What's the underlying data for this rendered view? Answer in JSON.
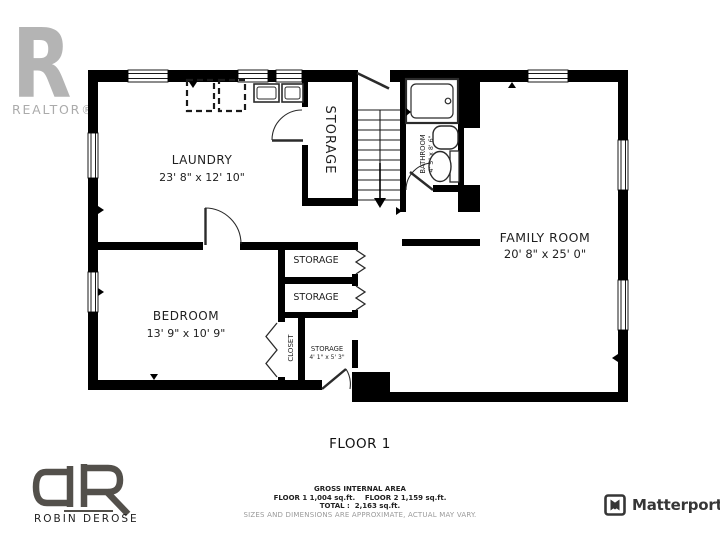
{
  "branding": {
    "realtor": {
      "letter": "R",
      "label": "REALTOR®"
    },
    "agent": {
      "initials": "dR",
      "name": "ROBIN DEROSE"
    },
    "matterport": {
      "label": "Matterport"
    }
  },
  "plan": {
    "floor_title": "FLOOR 1",
    "rooms": {
      "laundry": {
        "name": "LAUNDRY",
        "dims": "23' 8\" x 12' 10\""
      },
      "storage_main": {
        "name": "STORAGE"
      },
      "bathroom": {
        "name": "BATHROOM",
        "dims": "4' 5\" x 8' 6\""
      },
      "family_room": {
        "name": "FAMILY ROOM",
        "dims": "20' 8\" x 25' 0\""
      },
      "bedroom": {
        "name": "BEDROOM",
        "dims": "13' 9\" x 10' 9\""
      },
      "storage_upper": {
        "name": "STORAGE"
      },
      "storage_lower": {
        "name": "STORAGE"
      },
      "closet": {
        "name": "CLOSET"
      },
      "storage_small": {
        "name": "STORAGE",
        "dims": "4' 1\" x 5' 3\""
      }
    }
  },
  "area_summary": {
    "heading": "GROSS INTERNAL AREA",
    "floors_line": "FLOOR 1 1,004 sq.ft.    FLOOR 2 1,159 sq.ft.",
    "total_line": "TOTAL :  2,163 sq.ft.",
    "disclaimer": "SIZES AND DIMENSIONS ARE APPROXIMATE, ACTUAL MAY VARY."
  },
  "colors": {
    "wall": "#000000",
    "realtor_gray": "#b4b4b4",
    "agent_gray": "#53504b",
    "matterport_dark": "#363636",
    "disclaimer_gray": "#9a9a9a"
  }
}
